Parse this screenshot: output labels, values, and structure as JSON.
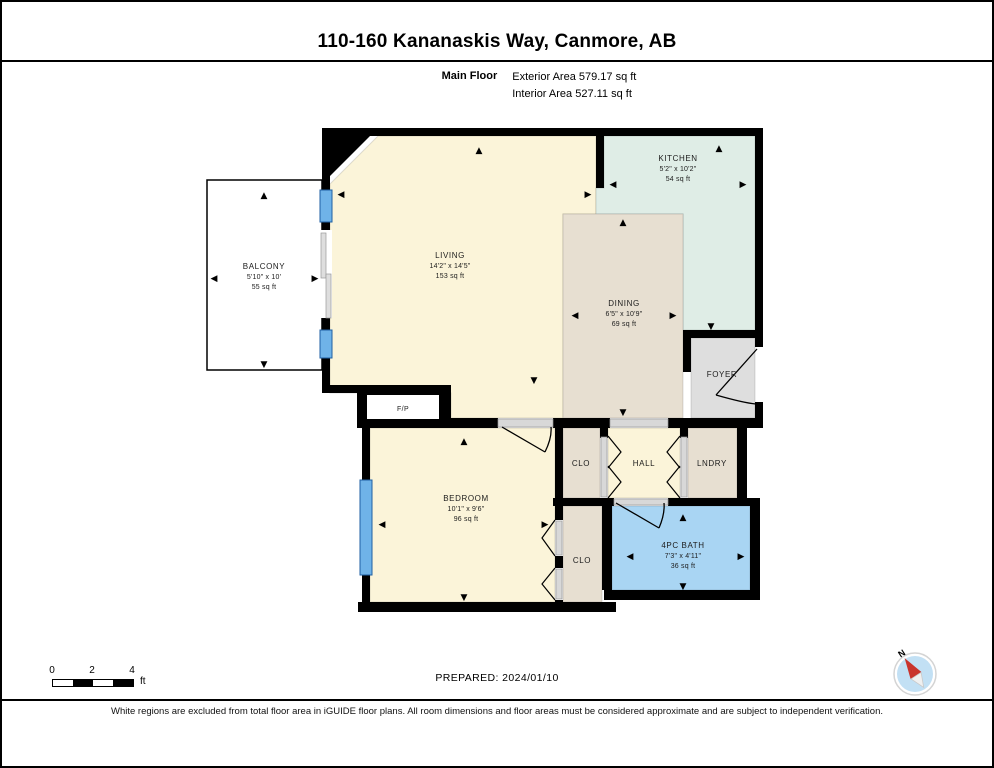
{
  "header": {
    "title": "110-160 Kananaskis Way, Canmore, AB",
    "floor_label": "Main Floor",
    "exterior_area": "Exterior Area 579.17 sq ft",
    "interior_area": "Interior Area 527.11 sq ft"
  },
  "rooms": {
    "balcony": {
      "name": "BALCONY",
      "dims": "5'10\" x 10'",
      "area": "55 sq ft"
    },
    "living": {
      "name": "LIVING",
      "dims": "14'2\" x 14'5\"",
      "area": "153 sq ft"
    },
    "kitchen": {
      "name": "KITCHEN",
      "dims": "5'2\" x 10'2\"",
      "area": "54 sq ft"
    },
    "dining": {
      "name": "DINING",
      "dims": "6'5\" x 10'9\"",
      "area": "69 sq ft"
    },
    "foyer": {
      "name": "FOYER"
    },
    "fireplace": {
      "name": "F/P"
    },
    "bedroom": {
      "name": "BEDROOM",
      "dims": "10'1\" x 9'6\"",
      "area": "96 sq ft"
    },
    "closet_hall": {
      "name": "CLO"
    },
    "hall": {
      "name": "HALL"
    },
    "laundry": {
      "name": "LNDRY"
    },
    "closet_bedroom": {
      "name": "CLO"
    },
    "bath": {
      "name": "4PC BATH",
      "dims": "7'3\" x 4'11\"",
      "area": "36 sq ft"
    }
  },
  "icons": {
    "arrow_up": "▲",
    "arrow_down": "▼",
    "arrow_left": "◀",
    "arrow_right": "▶",
    "compass_north": "N"
  },
  "footer": {
    "scale_ticks": [
      "0",
      "2",
      "4"
    ],
    "scale_unit": "ft",
    "prepared": "PREPARED: 2024/01/10",
    "disclaimer": "White regions are excluded from total floor area in iGUIDE floor plans. All room dimensions and floor areas must be considered approximate and are subject to independent verification."
  },
  "colors": {
    "wall": "#000000",
    "living": "#FBF4D9",
    "kitchen": "#DFEDE6",
    "dining": "#E7DFD1",
    "foyer": "#DEDEDE",
    "bath": "#A9D5F3",
    "window": "#6FB3E8",
    "compass_needle": "#C9342C"
  }
}
